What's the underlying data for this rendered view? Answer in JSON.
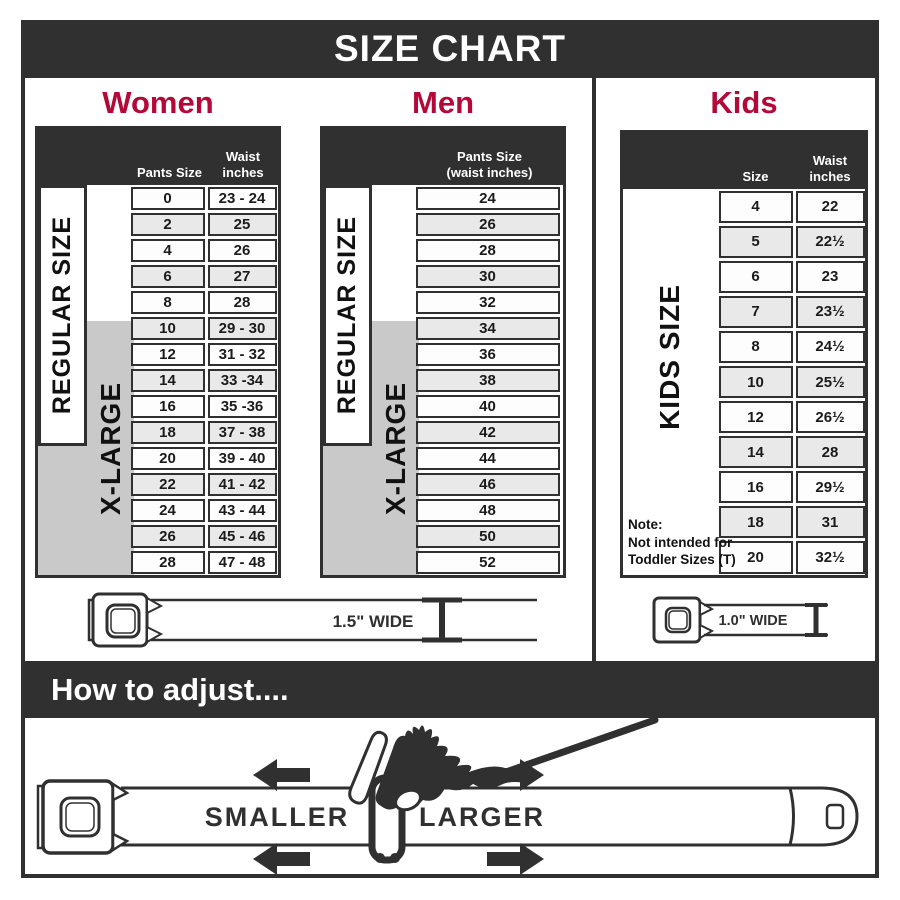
{
  "page": {
    "title": "SIZE CHART",
    "adjust_heading": "How to adjust...."
  },
  "colors": {
    "dark": "#303030",
    "accent_red": "#b30838",
    "row_alt": "#e9e9e9",
    "xlarge_gray": "#c9c9c9"
  },
  "sections": {
    "women": {
      "heading": "Women",
      "columns": {
        "size": "Pants Size",
        "waist": "Waist\ninches"
      },
      "regular_label": "REGULAR SIZE",
      "xlarge_label": "X-LARGE",
      "rows": [
        [
          "0",
          "23 - 24"
        ],
        [
          "2",
          "25"
        ],
        [
          "4",
          "26"
        ],
        [
          "6",
          "27"
        ],
        [
          "8",
          "28"
        ],
        [
          "10",
          "29 - 30"
        ],
        [
          "12",
          "31 - 32"
        ],
        [
          "14",
          "33 -34"
        ],
        [
          "16",
          "35 -36"
        ],
        [
          "18",
          "37 - 38"
        ],
        [
          "20",
          "39 - 40"
        ],
        [
          "22",
          "41 - 42"
        ],
        [
          "24",
          "43 - 44"
        ],
        [
          "26",
          "45 - 46"
        ],
        [
          "28",
          "47 - 48"
        ]
      ]
    },
    "men": {
      "heading": "Men",
      "column_header": "Pants Size\n(waist inches)",
      "regular_label": "REGULAR SIZE",
      "xlarge_label": "X-LARGE",
      "rows": [
        "24",
        "26",
        "28",
        "30",
        "32",
        "34",
        "36",
        "38",
        "40",
        "42",
        "44",
        "46",
        "48",
        "50",
        "52"
      ]
    },
    "kids": {
      "heading": "Kids",
      "columns": {
        "size": "Size",
        "waist": "Waist\ninches"
      },
      "side_label": "KIDS SIZE",
      "note": "Note:\nNot intended for\nToddler Sizes (T)",
      "rows": [
        [
          "4",
          "22"
        ],
        [
          "5",
          "22½"
        ],
        [
          "6",
          "23"
        ],
        [
          "7",
          "23½"
        ],
        [
          "8",
          "24½"
        ],
        [
          "10",
          "25½"
        ],
        [
          "12",
          "26½"
        ],
        [
          "14",
          "28"
        ],
        [
          "16",
          "29½"
        ],
        [
          "18",
          "31"
        ],
        [
          "20",
          "32½"
        ]
      ]
    }
  },
  "belt_labels": {
    "adult": "1.5\" WIDE",
    "kids": "1.0\" WIDE"
  },
  "adjust": {
    "smaller": "SMALLER",
    "larger": "LARGER"
  },
  "chart_data": [
    {
      "type": "table",
      "title": "Women",
      "columns": [
        "Pants Size",
        "Waist inches"
      ],
      "rows": [
        [
          "0",
          "23 - 24"
        ],
        [
          "2",
          "25"
        ],
        [
          "4",
          "26"
        ],
        [
          "6",
          "27"
        ],
        [
          "8",
          "28"
        ],
        [
          "10",
          "29 - 30"
        ],
        [
          "12",
          "31 - 32"
        ],
        [
          "14",
          "33 -34"
        ],
        [
          "16",
          "35 -36"
        ],
        [
          "18",
          "37 - 38"
        ],
        [
          "20",
          "39 - 40"
        ],
        [
          "22",
          "41 - 42"
        ],
        [
          "24",
          "43 - 44"
        ],
        [
          "26",
          "45 - 46"
        ],
        [
          "28",
          "47 - 48"
        ]
      ],
      "annotations": [
        "REGULAR SIZE spans pants sizes 0-18",
        "X-LARGE spans pants sizes 10-28",
        "Belt width 1.5\" WIDE"
      ]
    },
    {
      "type": "table",
      "title": "Men",
      "columns": [
        "Pants Size (waist inches)"
      ],
      "rows": [
        [
          "24"
        ],
        [
          "26"
        ],
        [
          "28"
        ],
        [
          "30"
        ],
        [
          "32"
        ],
        [
          "34"
        ],
        [
          "36"
        ],
        [
          "38"
        ],
        [
          "40"
        ],
        [
          "42"
        ],
        [
          "44"
        ],
        [
          "46"
        ],
        [
          "48"
        ],
        [
          "50"
        ],
        [
          "52"
        ]
      ],
      "annotations": [
        "REGULAR SIZE spans sizes 24-42",
        "X-LARGE spans sizes 34-52",
        "Belt width 1.5\" WIDE"
      ]
    },
    {
      "type": "table",
      "title": "Kids",
      "columns": [
        "Size",
        "Waist inches"
      ],
      "rows": [
        [
          "4",
          "22"
        ],
        [
          "5",
          "22½"
        ],
        [
          "6",
          "23"
        ],
        [
          "7",
          "23½"
        ],
        [
          "8",
          "24½"
        ],
        [
          "10",
          "25½"
        ],
        [
          "12",
          "26½"
        ],
        [
          "14",
          "28"
        ],
        [
          "16",
          "29½"
        ],
        [
          "18",
          "31"
        ],
        [
          "20",
          "32½"
        ]
      ],
      "annotations": [
        "KIDS SIZE",
        "Note: Not intended for Toddler Sizes (T)",
        "Belt width 1.0\" WIDE"
      ]
    }
  ]
}
